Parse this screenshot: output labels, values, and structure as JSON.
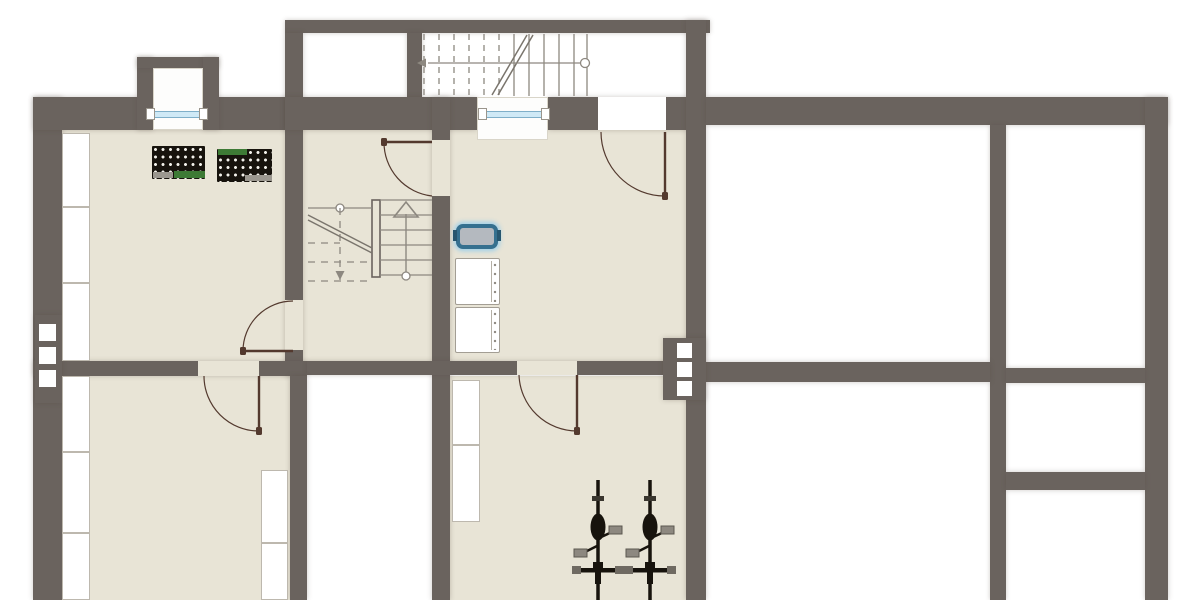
{
  "canvas": {
    "width": 1200,
    "height": 600,
    "background": "#ffffff"
  },
  "palette": {
    "wall": "#6a635e",
    "floor_beige": "#e8e4d6",
    "floor_white": "#ffffff",
    "door_line": "#53392e",
    "stair_line": "#8d8880",
    "window_glass": "#cfe9f6",
    "window_frame": "#7fafc9",
    "sink_border": "#35708f",
    "sink_fill": "#b4b9bf",
    "crate_dark": "#17130d",
    "crate_green": "#3d7a35",
    "crate_gray": "#9b978f",
    "bike_black": "#17130d",
    "pedal_gray": "#8d8880"
  },
  "floors": [
    {
      "id": "room-hobby",
      "rect": [
        62,
        130,
        225,
        231
      ],
      "fill": "floor"
    },
    {
      "id": "room-stair-hall",
      "rect": [
        303,
        130,
        129,
        231
      ],
      "fill": "floor"
    },
    {
      "id": "room-laundry",
      "rect": [
        450,
        130,
        236,
        231
      ],
      "fill": "floor"
    },
    {
      "id": "room-storage-left",
      "rect": [
        62,
        376,
        228,
        224
      ],
      "fill": "floor"
    },
    {
      "id": "room-bike-storage",
      "rect": [
        450,
        376,
        236,
        224
      ],
      "fill": "floor"
    },
    {
      "id": "room-store-top",
      "rect": [
        303,
        33,
        104,
        64
      ],
      "fill": "white"
    },
    {
      "id": "exterior-stairwell",
      "rect": [
        422,
        33,
        264,
        64
      ],
      "fill": "white"
    },
    {
      "id": "room-right-upper",
      "rect": [
        706,
        125,
        284,
        237
      ],
      "fill": "white"
    },
    {
      "id": "room-right-lower",
      "rect": [
        706,
        382,
        284,
        218
      ],
      "fill": "white"
    },
    {
      "id": "room-right-strip-1",
      "rect": [
        1006,
        125,
        139,
        243
      ],
      "fill": "white"
    },
    {
      "id": "room-right-strip-2",
      "rect": [
        1006,
        383,
        139,
        89
      ],
      "fill": "white"
    },
    {
      "id": "room-right-strip-3",
      "rect": [
        1006,
        490,
        139,
        110
      ],
      "fill": "white"
    },
    {
      "id": "room-mid-void",
      "rect": [
        307,
        375,
        125,
        225
      ],
      "fill": "white"
    }
  ],
  "walls": [
    [
      33,
      97,
      29,
      503
    ],
    [
      33,
      97,
      254,
      33
    ],
    [
      137,
      57,
      16,
      73
    ],
    [
      137,
      57,
      82,
      11
    ],
    [
      203,
      57,
      16,
      73
    ],
    [
      285,
      20,
      425,
      13
    ],
    [
      285,
      33,
      18,
      343
    ],
    [
      407,
      33,
      15,
      64
    ],
    [
      285,
      97,
      192,
      33
    ],
    [
      548,
      97,
      142,
      33
    ],
    [
      686,
      20,
      20,
      580
    ],
    [
      432,
      97,
      18,
      503
    ],
    [
      33,
      361,
      274,
      15
    ],
    [
      307,
      361,
      379,
      14
    ],
    [
      290,
      376,
      17,
      224
    ],
    [
      706,
      97,
      462,
      28
    ],
    [
      1145,
      97,
      23,
      503
    ],
    [
      990,
      125,
      16,
      475
    ],
    [
      706,
      362,
      284,
      20
    ],
    [
      1006,
      368,
      139,
      15
    ],
    [
      1006,
      472,
      139,
      18
    ]
  ],
  "openings": [
    {
      "id": "door-gap-hall-hobby",
      "fill": "floor",
      "rect": [
        285,
        300,
        18,
        50
      ]
    },
    {
      "id": "door-gap-hall-laundry",
      "fill": "floor",
      "rect": [
        432,
        140,
        18,
        56
      ]
    },
    {
      "id": "door-gap-hobby-storage",
      "fill": "floor",
      "rect": [
        198,
        361,
        61,
        15
      ]
    },
    {
      "id": "door-gap-laundry-bikes",
      "fill": "floor",
      "rect": [
        517,
        361,
        60,
        14
      ]
    },
    {
      "id": "entrance-door-gap",
      "fill": "white",
      "rect": [
        598,
        97,
        68,
        33
      ]
    },
    {
      "id": "bay-window-niche",
      "fill": "white",
      "rect": [
        153,
        68,
        50,
        62
      ],
      "niche": true
    },
    {
      "id": "laundry-window-niche",
      "fill": "white",
      "rect": [
        477,
        97,
        71,
        43
      ],
      "niche": true
    }
  ],
  "chimneys": [
    {
      "id": "chimney-left",
      "block": [
        35,
        315,
        27,
        88
      ],
      "flues": [
        [
          39,
          324,
          17,
          17
        ],
        [
          39,
          347,
          17,
          17
        ],
        [
          39,
          370,
          17,
          17
        ]
      ]
    },
    {
      "id": "chimney-laundry",
      "block": [
        663,
        338,
        43,
        62
      ],
      "flues": [
        [
          677,
          343,
          15,
          15
        ],
        [
          677,
          362,
          15,
          15
        ],
        [
          677,
          381,
          15,
          15
        ]
      ]
    }
  ],
  "windows": [
    {
      "id": "bay-window",
      "glass": [
        154,
        111,
        46,
        7
      ],
      "caps": [
        [
          146,
          108,
          9,
          12
        ],
        [
          199,
          108,
          9,
          12
        ]
      ]
    },
    {
      "id": "laundry-window",
      "glass": [
        487,
        111,
        55,
        7
      ],
      "caps": [
        [
          478,
          108,
          9,
          12
        ],
        [
          541,
          108,
          9,
          12
        ]
      ]
    }
  ],
  "doors": [
    {
      "id": "entrance-door",
      "leaf": [
        665,
        132,
        665,
        196
      ],
      "arc": {
        "r": 64,
        "from": [
          601,
          132
        ],
        "to": [
          665,
          196
        ]
      },
      "dot": [
        665,
        196
      ]
    },
    {
      "id": "door-hall-laundry",
      "leaf": [
        384,
        142,
        432,
        142
      ],
      "arc": {
        "r": 54,
        "from": [
          384,
          142
        ],
        "to": [
          432,
          196
        ]
      },
      "dot": [
        384,
        142
      ]
    },
    {
      "id": "door-hall-hobby",
      "leaf": [
        243,
        351,
        293,
        351
      ],
      "arc": {
        "r": 50,
        "from": [
          293,
          301
        ],
        "to": [
          243,
          351
        ]
      },
      "dot": [
        243,
        351
      ]
    },
    {
      "id": "door-hobby-storage",
      "leaf": [
        259,
        376,
        259,
        431
      ],
      "arc": {
        "r": 55,
        "from": [
          204,
          376
        ],
        "to": [
          259,
          431
        ]
      },
      "dot": [
        259,
        431
      ]
    },
    {
      "id": "door-laundry-bikes",
      "leaf": [
        577,
        375,
        577,
        431
      ],
      "arc": {
        "r": 58,
        "from": [
          519,
          375
        ],
        "to": [
          577,
          431
        ]
      },
      "dot": [
        577,
        431
      ]
    }
  ],
  "exterior_stairs": {
    "id": "exterior-staircase",
    "treads_dashed_x": [
      424,
      439,
      454,
      469,
      484,
      499
    ],
    "treads_solid_x": [
      514,
      529,
      544,
      559,
      574,
      587
    ],
    "tread_y": [
      34,
      96
    ],
    "cut_lines": [
      [
        492,
        95,
        527,
        35
      ],
      [
        498,
        95,
        533,
        35
      ]
    ],
    "handrail": {
      "y": 63,
      "x1": 430,
      "x2": 583
    },
    "start_circle": [
      585,
      63,
      4.5
    ],
    "arrow_tip": [
      417,
      63
    ]
  },
  "interior_stairs": {
    "id": "interior-staircase",
    "stringer": [
      372,
      200,
      8,
      77
    ],
    "right_treads_y": [
      200,
      215,
      230,
      245,
      260,
      275
    ],
    "right_tread_x": [
      380,
      432
    ],
    "up_arrow": {
      "shaft_x": 406,
      "y1": 214,
      "y2": 274,
      "head": [
        [
          394,
          217
        ],
        [
          418,
          217
        ],
        [
          406,
          202
        ]
      ],
      "circle": [
        406,
        276,
        4
      ]
    },
    "left_rail": {
      "y": 208,
      "x1": 308,
      "x2": 372,
      "circle": [
        340,
        208,
        4
      ]
    },
    "left_dashed_h": [
      [
        308,
        243,
        340,
        243
      ],
      [
        308,
        262,
        372,
        262
      ],
      [
        308,
        281,
        372,
        281
      ]
    ],
    "left_dashed_v": [
      340,
      208,
      340,
      281
    ],
    "cut_lines": [
      [
        308,
        215,
        372,
        248
      ],
      [
        308,
        220,
        372,
        253
      ]
    ],
    "down_arrow_tip": [
      340,
      280
    ]
  },
  "closets": [
    [
      62,
      133,
      28,
      74
    ],
    [
      62,
      207,
      28,
      76
    ],
    [
      62,
      283,
      28,
      78
    ],
    [
      62,
      376,
      28,
      76
    ],
    [
      62,
      452,
      28,
      81
    ],
    [
      62,
      533,
      28,
      67
    ],
    [
      261,
      470,
      27,
      73
    ],
    [
      261,
      543,
      27,
      57
    ],
    [
      452,
      380,
      28,
      65
    ],
    [
      452,
      445,
      28,
      77
    ]
  ],
  "fixtures": {
    "sink": {
      "id": "utility-sink",
      "rect": [
        456,
        224,
        42,
        25
      ],
      "tabs": [
        [
          453,
          230,
          4,
          11
        ],
        [
          497,
          230,
          4,
          11
        ]
      ]
    },
    "washers": [
      {
        "id": "washing-machine-1",
        "rect": [
          455,
          258,
          45,
          47
        ]
      },
      {
        "id": "washing-machine-2",
        "rect": [
          455,
          307,
          45,
          46
        ]
      }
    ],
    "crates": [
      {
        "id": "beverage-crates-1",
        "rect": [
          152,
          146,
          53,
          33
        ],
        "strips": [
          {
            "rect": [
              174,
              171,
              31,
              7
            ],
            "color": "green"
          },
          {
            "rect": [
              153,
              172,
              20,
              6
            ],
            "color": "gray"
          }
        ]
      },
      {
        "id": "beverage-crates-2",
        "rect": [
          217,
          149,
          55,
          33
        ],
        "strips": [
          {
            "rect": [
              218,
              149,
              29,
              6
            ],
            "color": "green"
          },
          {
            "rect": [
              245,
              175,
              27,
              6
            ],
            "color": "gray"
          }
        ]
      }
    ],
    "bikes": [
      {
        "id": "bicycle-1",
        "cx": 598,
        "top": 480,
        "bottom": 600
      },
      {
        "id": "bicycle-2",
        "cx": 650,
        "top": 480,
        "bottom": 600
      }
    ]
  }
}
